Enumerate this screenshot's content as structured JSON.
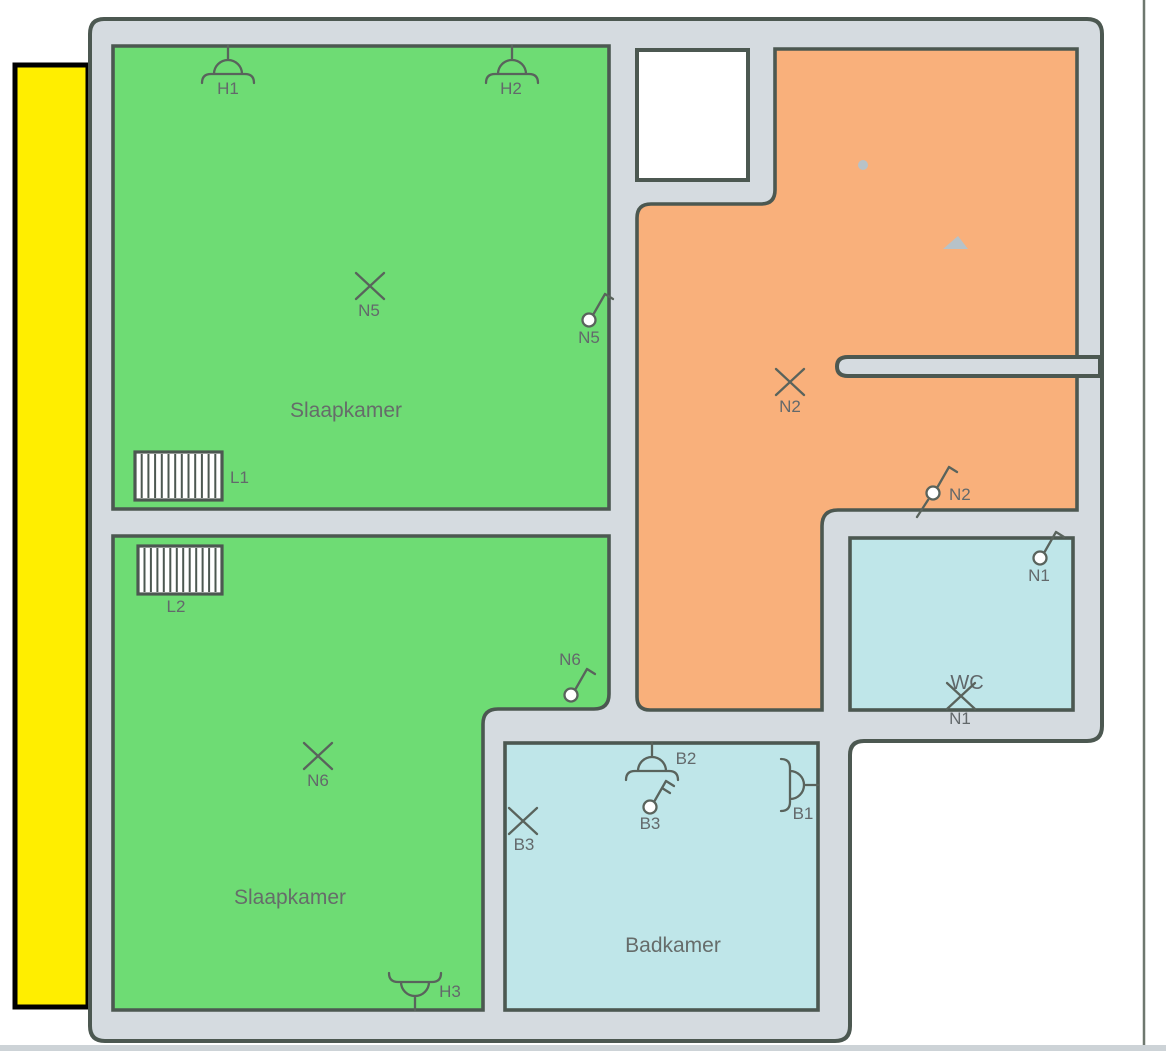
{
  "page": {
    "frame_line_color": "#6e786f",
    "bottom_strip_color": "#cdd3d7"
  },
  "colors": {
    "wall_fill": "#d5dbe0",
    "wall_line": "#4c5851",
    "bedroom_green": "#6edc74",
    "hall_orange": "#f9b07b",
    "bath_cyan": "#bfe6e9",
    "highlight_yellow": "#ffee00",
    "symbol": "#59635c",
    "label_text": "#63696b",
    "artifact_gray": "#b7c2c8"
  },
  "rooms": [
    {
      "id": "slaapkamer-1",
      "label": "Slaapkamer"
    },
    {
      "id": "slaapkamer-2",
      "label": "Slaapkamer"
    },
    {
      "id": "badkamer",
      "label": "Badkamer"
    },
    {
      "id": "wc",
      "label": "WC"
    }
  ],
  "symbols": [
    {
      "id": "H1",
      "kind": "wall-light",
      "orient": "down",
      "x": 228,
      "y": 46,
      "label": "H1",
      "lx": 228,
      "ly": 94
    },
    {
      "id": "H2",
      "kind": "wall-light",
      "orient": "down",
      "x": 512,
      "y": 46,
      "label": "H2",
      "lx": 511,
      "ly": 94
    },
    {
      "id": "H3",
      "kind": "wall-light",
      "orient": "up",
      "x": 415,
      "y": 1010,
      "label": "H3",
      "lx": 450,
      "ly": 997
    },
    {
      "id": "B2",
      "kind": "wall-light",
      "orient": "down",
      "x": 652,
      "y": 743,
      "label": "B2",
      "lx": 686,
      "ly": 764
    },
    {
      "id": "B1",
      "kind": "wall-light",
      "orient": "right",
      "x": 818,
      "y": 785,
      "label": "B1",
      "lx": 803,
      "ly": 819
    },
    {
      "id": "N5-lamp",
      "kind": "ceiling-light",
      "x": 370,
      "y": 286,
      "label": "N5",
      "lx": 369,
      "ly": 316
    },
    {
      "id": "N6-lamp",
      "kind": "ceiling-light",
      "x": 318,
      "y": 756,
      "label": "N6",
      "lx": 318,
      "ly": 786
    },
    {
      "id": "N2-lamp",
      "kind": "ceiling-light",
      "x": 790,
      "y": 382,
      "label": "N2",
      "lx": 790,
      "ly": 412
    },
    {
      "id": "B3-lamp",
      "kind": "ceiling-light",
      "x": 523,
      "y": 821,
      "label": "B3",
      "lx": 524,
      "ly": 850
    },
    {
      "id": "N1-lamp",
      "kind": "ceiling-light",
      "x": 961,
      "y": 696,
      "label": "N1",
      "lx": 960,
      "ly": 724
    },
    {
      "id": "N5-switch",
      "kind": "switch",
      "x": 589,
      "y": 320,
      "label": "N5",
      "lx": 589,
      "ly": 343
    },
    {
      "id": "N6-switch",
      "kind": "switch",
      "x": 571,
      "y": 695,
      "label": "N6",
      "lx": 570,
      "ly": 665
    },
    {
      "id": "N2-switch",
      "kind": "switch",
      "tail": true,
      "x": 933,
      "y": 493,
      "label": "N2",
      "lx": 949,
      "ly": 500,
      "anchor": "start"
    },
    {
      "id": "N1-switch",
      "kind": "switch",
      "x": 1040,
      "y": 558,
      "label": "N1",
      "lx": 1039,
      "ly": 581
    },
    {
      "id": "B3-switch",
      "kind": "switch",
      "ticks": 2,
      "x": 650,
      "y": 807,
      "label": "B3",
      "lx": 650,
      "ly": 829
    }
  ],
  "radiators": [
    {
      "id": "L1",
      "x": 135,
      "y": 452,
      "w": 87,
      "h": 48,
      "label": "L1",
      "lx": 230,
      "ly": 483,
      "anchor": "start"
    },
    {
      "id": "L2",
      "x": 138,
      "y": 546,
      "w": 84,
      "h": 48,
      "label": "L2",
      "lx": 176,
      "ly": 612,
      "anchor": "middle"
    }
  ]
}
